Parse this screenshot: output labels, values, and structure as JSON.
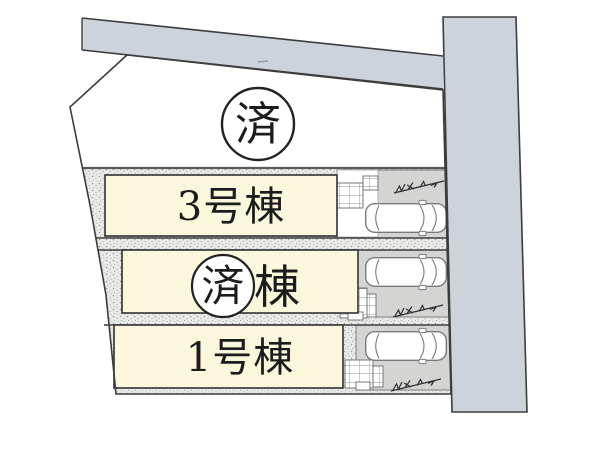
{
  "plan": {
    "type": "site-layout-plan",
    "sold_badge": {
      "label": "済"
    },
    "plots": [
      {
        "id": "plot-3",
        "label": "3号棟",
        "status": "available"
      },
      {
        "id": "plot-2",
        "badge": "済",
        "suffix": "棟",
        "status": "sold"
      },
      {
        "id": "plot-1",
        "label": "1号棟",
        "status": "available"
      }
    ],
    "icons": {
      "car": "car-top-view-icon",
      "porch": "porch-tile-grid-icon",
      "dimension": "dimension-mark-icon"
    },
    "colors": {
      "road": "#cdd3da",
      "parking": "#d4d4d2",
      "plot_fill": "#fbf7dc",
      "stipple_base": "#e9e9e7",
      "outline": "#3c3c3c"
    }
  }
}
